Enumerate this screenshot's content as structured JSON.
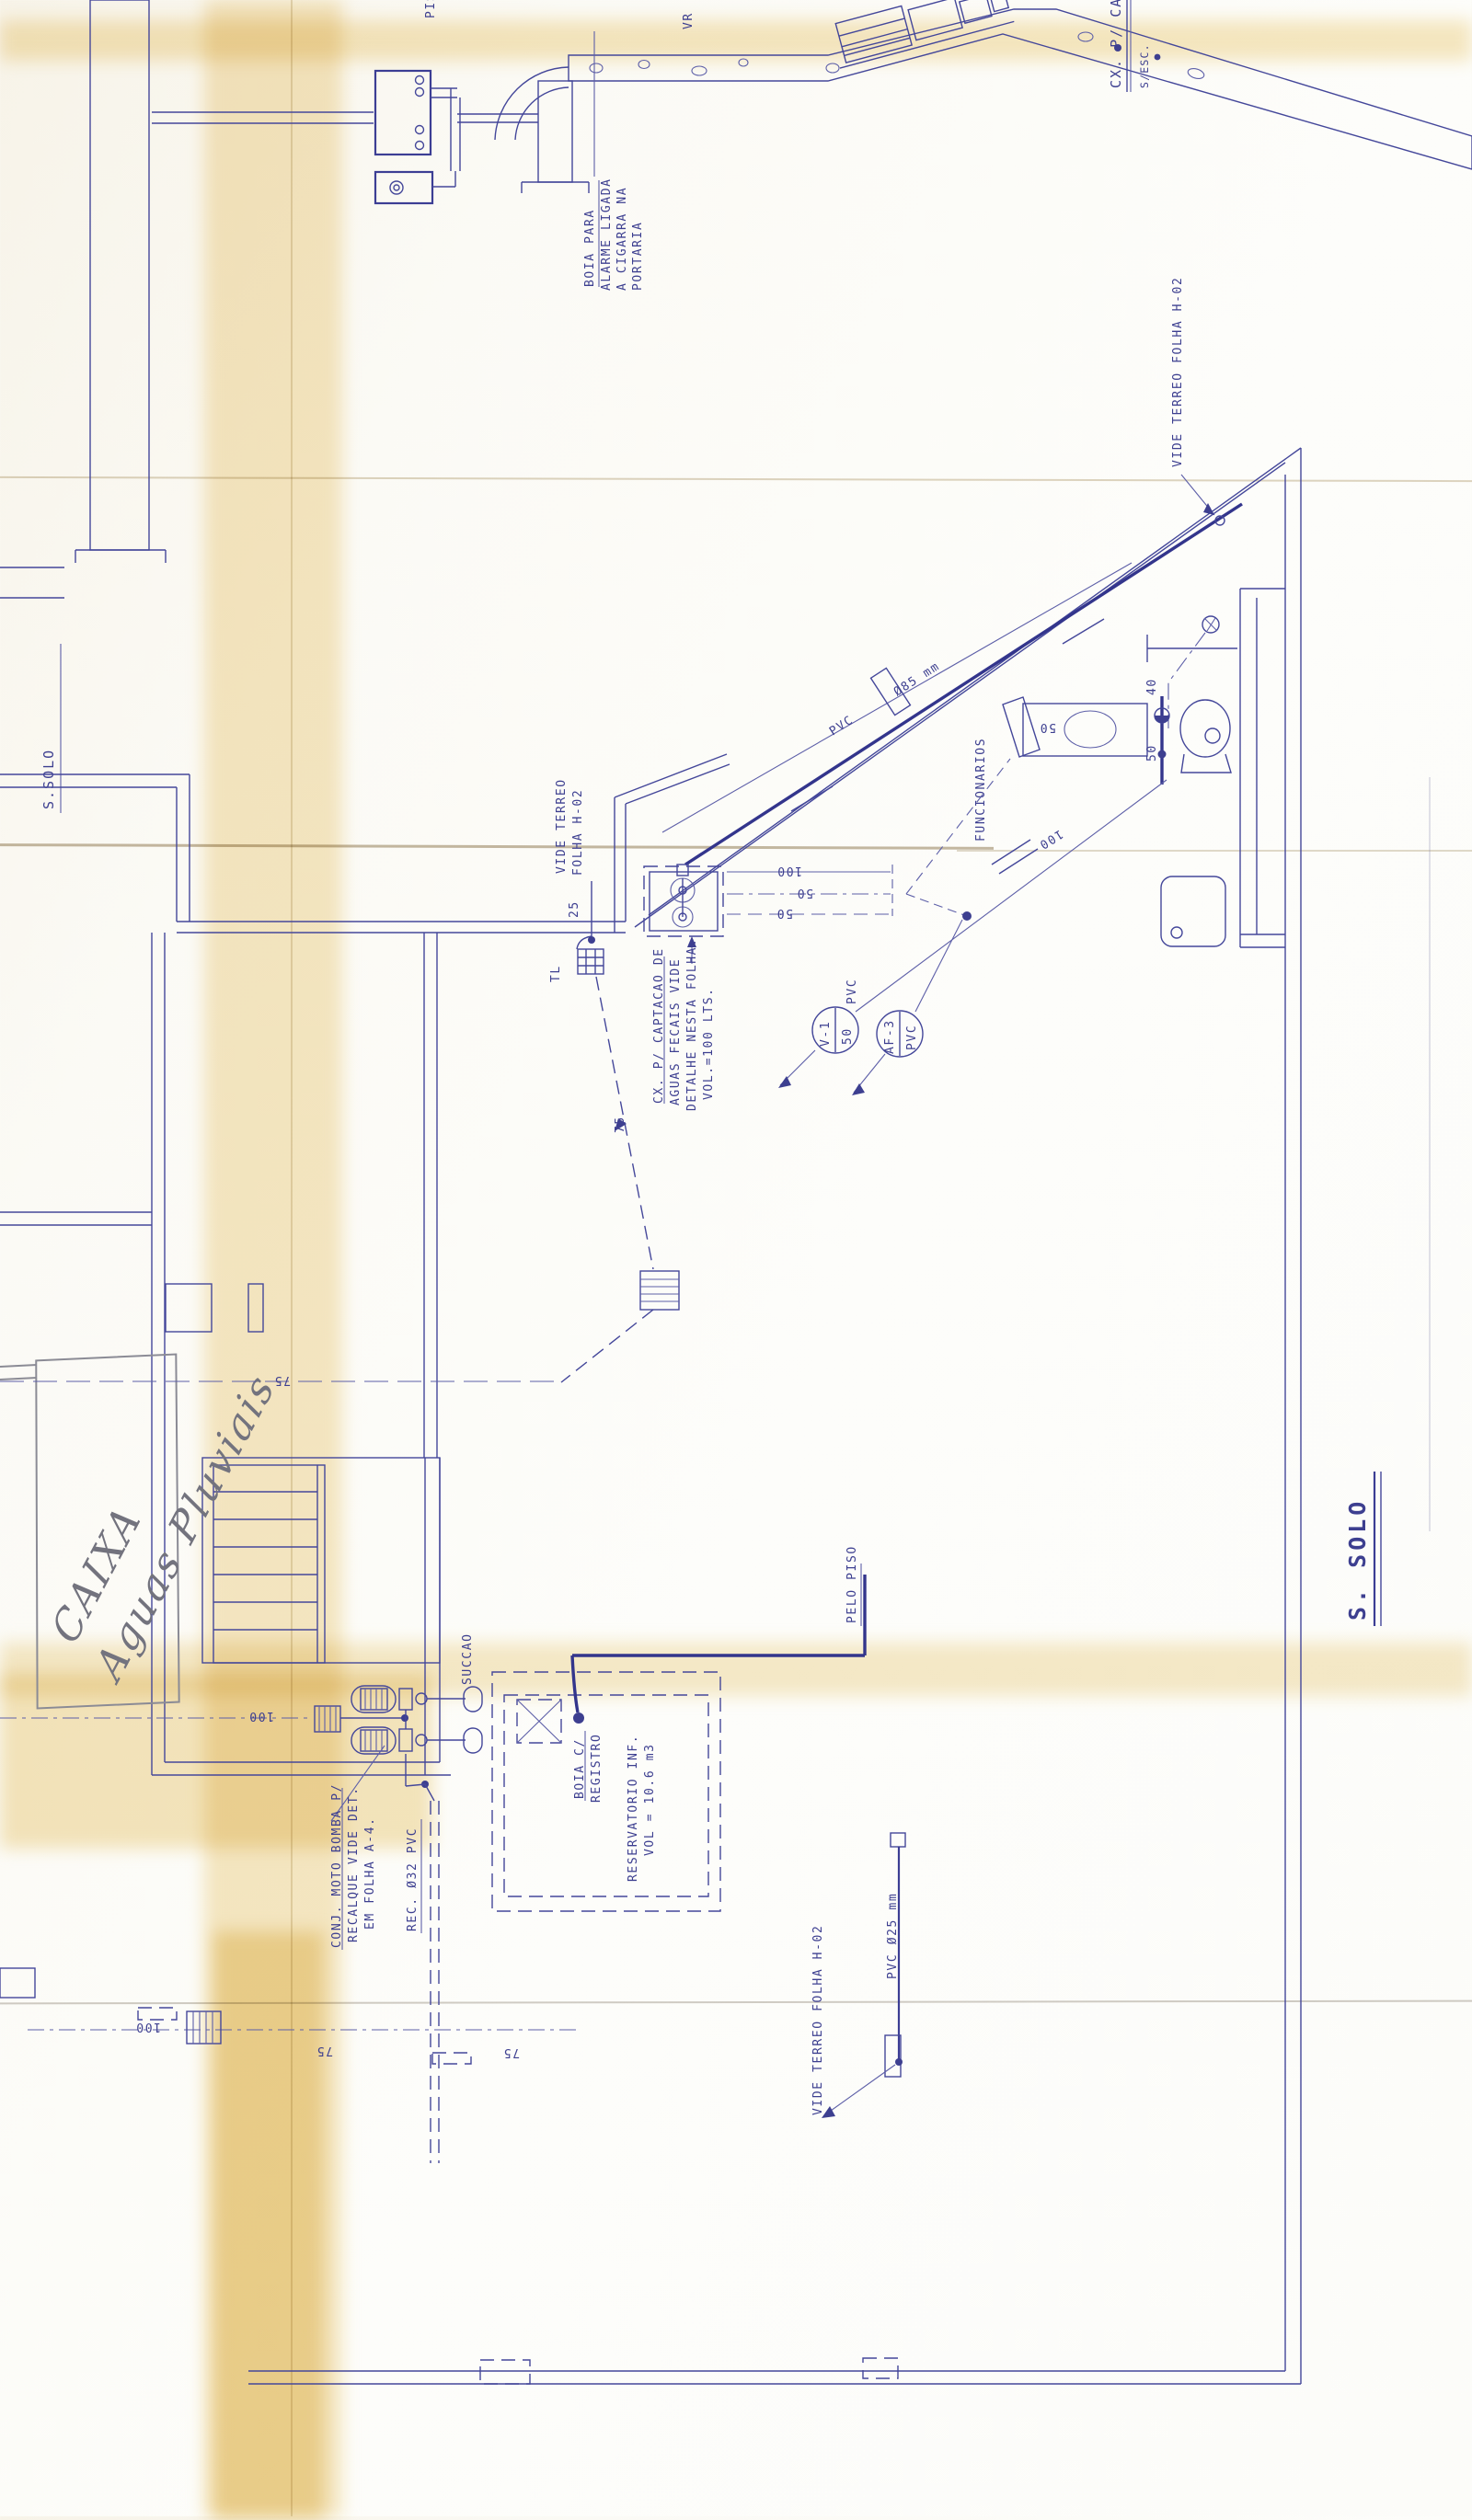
{
  "meta": {
    "ink_color": "#3d3f90",
    "paper_color": "#fbfaf5",
    "stain_color": "#efd9a0",
    "pencil_color": "#8b8b95",
    "drawing_type": "hydraulic installation floor plan (subsolo)"
  },
  "titles": {
    "left_section": "S.SOLO",
    "right_section": "S. SOLO",
    "top_right_detail": "CX. P/ CA",
    "top_right_scale": "S/ESC."
  },
  "top_detail": {
    "pis_partial": "PIS",
    "vr": "VR",
    "boia_line1": "BOIA PARA",
    "boia_line2": "ALARME LIGADA",
    "boia_line3": "A CIGARRA NA",
    "boia_line4": "PORTARIA"
  },
  "plan": {
    "vide_terreo_top": "VIDE TERREO FOLHA  H-02",
    "diag_pipe_material": "PVC",
    "diag_pipe_diameter": "Ø85 mm",
    "bathroom": {
      "room_label": "FUNCIONARIOS",
      "wc_branch": "50",
      "riser_40": "40",
      "riser_50": "50",
      "diag_100": "100"
    },
    "branch_100": "100",
    "branch_50a": "50",
    "branch_50b": "50",
    "sink_area": {
      "vide_terreo_l1": "VIDE TERREO",
      "vide_terreo_l2": "FOLHA H-02",
      "dim_25": "25",
      "tl": "TL",
      "caption_l1": "CX. P/ CAPTACAO DE",
      "caption_l2": "AGUAS FECAIS VIDE",
      "caption_l3": "DETALHE NESTA FOLHA.",
      "caption_l4": "VOL.=100 LTS.",
      "tag1_name": "V-1",
      "tag1_size": "50",
      "tag1_material": "PVC",
      "tag2_name": "AF-3",
      "tag2_material": "PVC",
      "drop_75": "75"
    },
    "corridor_75": "75",
    "feed_100": "100",
    "handwritten_l1": "CAIXA",
    "handwritten_l2": "Aguas Pluviais",
    "pump_room": {
      "succao": "SUCCAO",
      "conj_l1": "CONJ. MOTO BOMBA P/",
      "conj_l2": "RECALQUE  VIDE DET.",
      "conj_l3": "EM FOLHA  A-4.",
      "rec_pipe": "REC. Ø32 PVC"
    },
    "reservoir": {
      "boia_l1": "BOIA C/",
      "boia_l2": "REGISTRO",
      "res_l1": "RESERVATORIO  INF.",
      "res_l2": "VOL = 10.6 m3",
      "pelo_piso": "PELO PISO"
    },
    "bottom": {
      "pvc25": "PVC  Ø25 mm",
      "vide_terreo": "VIDE TERREO FOLHA H-02",
      "dim_100": "100",
      "dim_75a": "75",
      "dim_75b": "75"
    }
  }
}
